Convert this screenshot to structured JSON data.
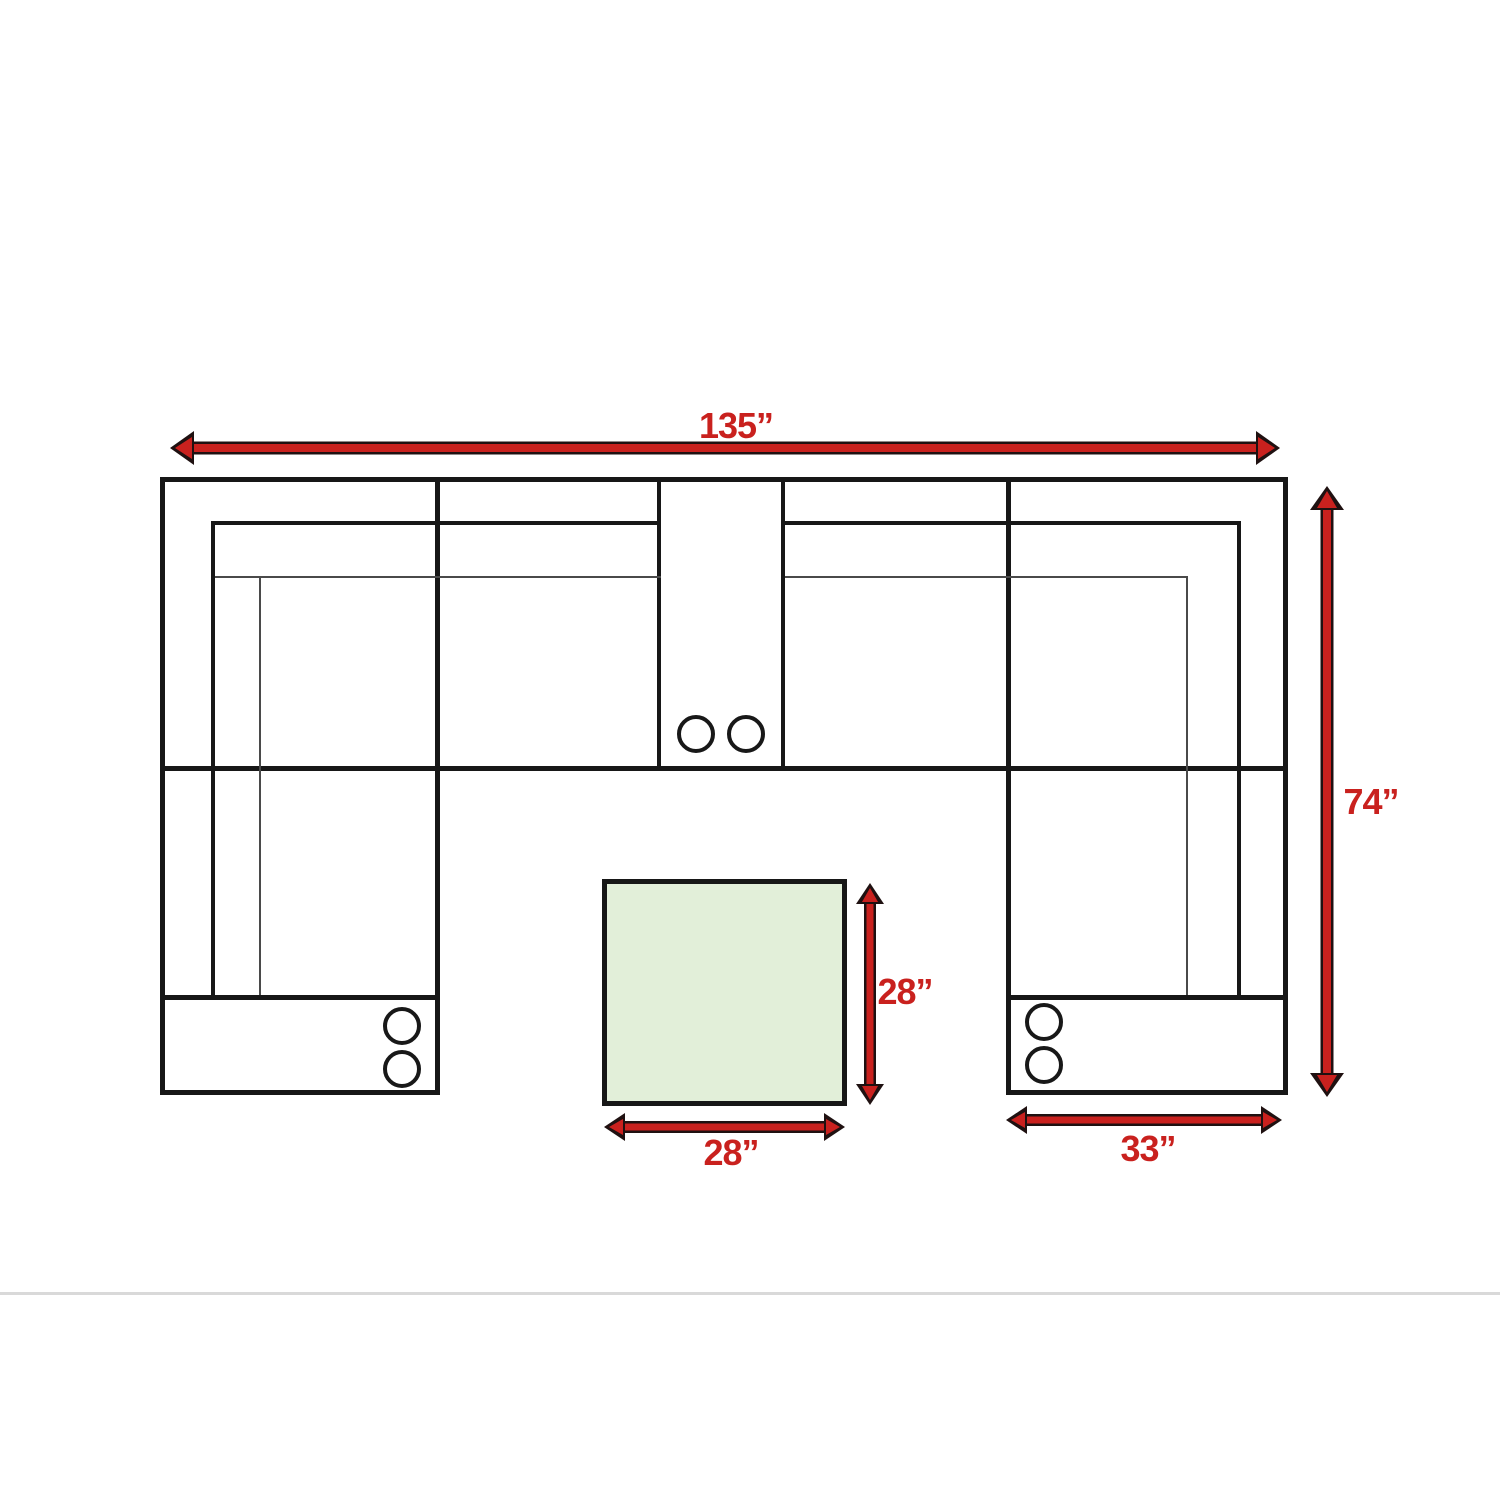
{
  "diagram": {
    "colors": {
      "dimension_red": "#c9211e",
      "outline_black": "#171717",
      "ottoman_fill_green": "#e2efd9",
      "page_divider_gray": "#d9d9d9",
      "background": "#ffffff"
    },
    "dimensions": {
      "sofa_total_width": "135”",
      "sofa_total_depth": "74”",
      "ottoman_depth": "28”",
      "ottoman_width": "28”",
      "right_chaise_width": "33”"
    }
  }
}
